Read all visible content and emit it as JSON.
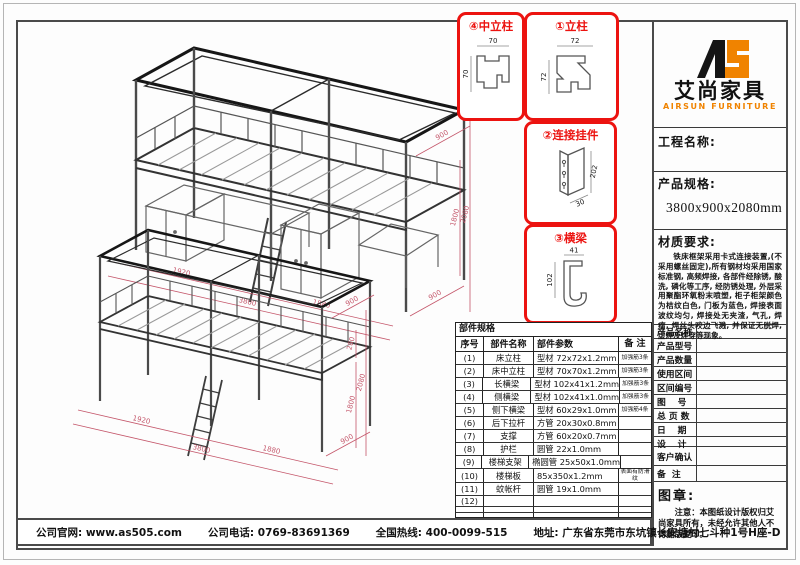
{
  "colors": {
    "accent_red": "#ec1310",
    "dimension_red": "#c4566a",
    "brand_orange": "#f08300"
  },
  "brand": {
    "logo_text": "AS",
    "name_cn": "艾尚家具",
    "name_en": "AIRSUN FURNITURE"
  },
  "project": {
    "label": "工程名称:",
    "value": ""
  },
  "spec": {
    "label": "产品规格:",
    "value": "3800x900x2080mm"
  },
  "material": {
    "label": "材质要求:",
    "text": "铁床框架采用卡式连接装置,(不采用螺丝固定),所有钢材均采用国家标准钢, 高频焊接, 各部件经除锈, 酸洗, 磷化等工序, 经防锈处理, 外层采用聚酯环氧粉末喷塑, 柜子柜架颜色为桔纹白色, 门板为蓝色, 焊接表面波纹均匀, 焊接处无夹渣, 气孔, 焊瘤, 焊丝头咬边飞溅, 并保证无脱焊, 虚焊及焊穿等现象。"
  },
  "detail_callouts": [
    {
      "title": "④中立柱",
      "dim_top": "70",
      "dim_side": "70"
    },
    {
      "title": "①立柱",
      "dim_top": "72",
      "dim_side": "72"
    },
    {
      "title": "②连接挂件",
      "dim_side": "202",
      "dim_bottom": "30"
    },
    {
      "title": "③横梁",
      "dim_top": "41",
      "dim_side": "102"
    }
  ],
  "parts_table": {
    "title": "部件规格",
    "headers": [
      "序号",
      "部件名称",
      "部件参数",
      "备 注"
    ],
    "rows": [
      {
        "no": "(1)",
        "name": "床立柱",
        "param": "型材 72x72x1.2mm",
        "remark": "加强筋3条"
      },
      {
        "no": "(2)",
        "name": "床中立柱",
        "param": "型材 70x70x1.2mm",
        "remark": "加强筋3条"
      },
      {
        "no": "(3)",
        "name": "长横梁",
        "param": "型材 102x41x1.2mm",
        "remark": "加强筋3条"
      },
      {
        "no": "(4)",
        "name": "侧横梁",
        "param": "型材 102x41x1.0mm",
        "remark": "加强筋3条"
      },
      {
        "no": "(5)",
        "name": "侧下横梁",
        "param": "型材 60x29x1.0mm",
        "remark": "加强筋4条"
      },
      {
        "no": "(6)",
        "name": "后下拉杆",
        "param": "方管 20x30x0.8mm",
        "remark": ""
      },
      {
        "no": "(7)",
        "name": "支撑",
        "param": "方管 60x20x0.7mm",
        "remark": ""
      },
      {
        "no": "(8)",
        "name": "护栏",
        "param": "圆管 22x1.0mm",
        "remark": ""
      },
      {
        "no": "(9)",
        "name": "楼梯支架",
        "param": "椭圆管 25x50x1.0mm",
        "remark": ""
      },
      {
        "no": "(10)",
        "name": "楼梯板",
        "param": "85x350x1.2mm",
        "remark": "表面有防滑纹"
      },
      {
        "no": "(11)",
        "name": "蚊帐杆",
        "param": "圆管 19x1.0mm",
        "remark": ""
      },
      {
        "no": "(12)",
        "name": "",
        "param": "",
        "remark": ""
      },
      {
        "no": "",
        "name": "",
        "param": "",
        "remark": ""
      },
      {
        "no": "",
        "name": "",
        "param": "",
        "remark": ""
      }
    ]
  },
  "info_panel": {
    "rows": [
      {
        "label": "产品名称",
        "value": ""
      },
      {
        "label": "产品型号",
        "value": ""
      },
      {
        "label": "产品数量",
        "value": ""
      },
      {
        "label": "使用区间",
        "value": ""
      },
      {
        "label": "区间编号",
        "value": ""
      },
      {
        "label": "图　 号",
        "value": ""
      },
      {
        "label": "总 页 数",
        "value": ""
      },
      {
        "label": "日　 期",
        "value": ""
      },
      {
        "label": "设　 计",
        "value": ""
      }
    ],
    "customer_label": "客户确认",
    "remark_label": "备  注"
  },
  "stamp": {
    "label": "图章:",
    "note": "注意：本图纸设计版权归艾尚家具所有，未经允许其他人不得翻版复印。"
  },
  "footer": {
    "website_label": "公司官网:",
    "website": "www.as505.com",
    "phone_label": "公司电话:",
    "phone": "0769-83691369",
    "hotline_label": "全国热线:",
    "hotline": "400-0099-515",
    "address_label": "地址:",
    "address": "广东省东莞市东坑镇长安塘村七斗种1号H座-D"
  },
  "drawings": {
    "top": {
      "dims": {
        "seg1": "1920",
        "seg2": "1880",
        "total": "3800",
        "depth": "900",
        "height_mid": "1800",
        "height_total": "2080",
        "depth_floor": "900"
      }
    },
    "bottom": {
      "dims": {
        "seg1": "1920",
        "seg2": "1880",
        "total": "3800",
        "depth": "900",
        "rail": "280",
        "height_mid": "1800",
        "height_total": "2080",
        "depth_floor": "900"
      }
    }
  }
}
